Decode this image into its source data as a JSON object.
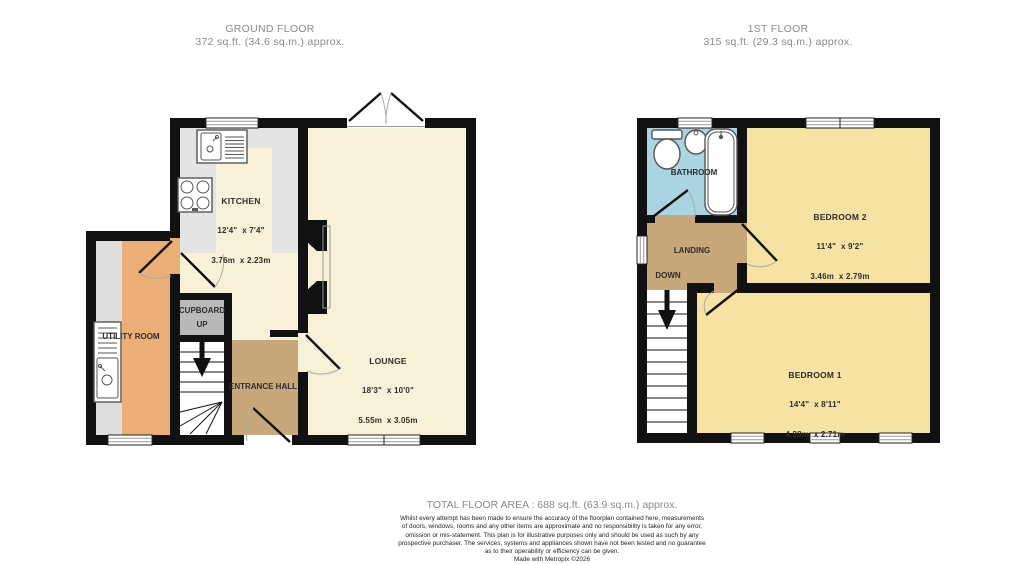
{
  "ground_floor": {
    "title": "GROUND FLOOR",
    "area_line": "372 sq.ft. (34.6 sq.m.) approx.",
    "kitchen": {
      "name": "KITCHEN",
      "imperial": "12'4\"  x 7'4\"",
      "metric": "3.76m  x 2.23m"
    },
    "lounge": {
      "name": "LOUNGE",
      "imperial": "18'3\"  x 10'0\"",
      "metric": "5.55m  x 3.05m"
    },
    "utility": {
      "name": "UTILITY ROOM"
    },
    "cupboard": {
      "name": "CUPBOARD",
      "stair_label": "UP"
    },
    "entrance_hall": {
      "name": "ENTRANCE HALL"
    }
  },
  "first_floor": {
    "title": "1ST FLOOR",
    "area_line": "315 sq.ft. (29.3 sq.m.) approx.",
    "bathroom": {
      "name": "BATHROOM"
    },
    "landing": {
      "name": "LANDING",
      "stair_label": "DOWN"
    },
    "bedroom2": {
      "name": "BEDROOM 2",
      "imperial": "11'4\"  x 9'2\"",
      "metric": "3.46m  x 2.79m"
    },
    "bedroom1": {
      "name": "BEDROOM 1",
      "imperial": "14'4\"  x 8'11\"",
      "metric": "4.38m  x 2.71m"
    }
  },
  "footer": {
    "total_area": "TOTAL FLOOR AREA : 688 sq.ft. (63.9 sq.m.) approx.",
    "disclaimer": [
      "Whilst every attempt has been made to ensure the accuracy of the floorplan contained here, measurements",
      "of doors, windows, rooms and any other items are approximate and no responsibility is taken for any error,",
      "omission or mis-statement. This plan is for illustrative purposes only and should be used as such by any",
      "prospective purchaser. The services, systems and appliances shown have not been tested and no guarantee",
      "as to their operability or efficiency can be given.",
      "Made with Metropix ©2026"
    ]
  },
  "colors": {
    "wall": "#111111",
    "room_cream": "#f7f1d8",
    "kitchen_floor": "#e4e4e4",
    "counter_gray": "#dedede",
    "cupboard_gray": "#b9b9b9",
    "utility_orange": "#ecae77",
    "hall_tan": "#c8a77b",
    "bedroom_yellow": "#f6e2a3",
    "bathroom_blue": "#a9d4e1"
  }
}
